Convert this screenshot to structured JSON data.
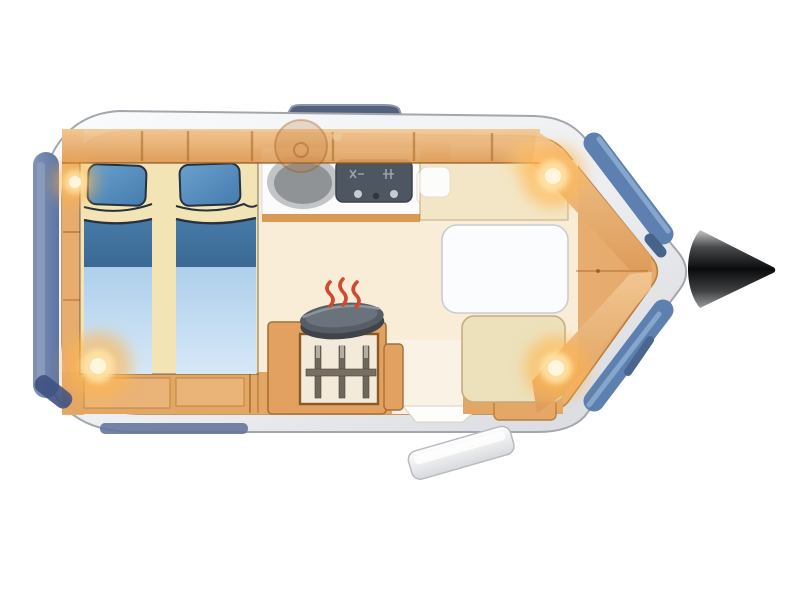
{
  "illustration": {
    "type": "caravan-floor-plan-top-view",
    "description_parts": [
      "body-shell",
      "tow-hitch-cone",
      "roof-hatch",
      "rear-window-left",
      "front-panorama-window-top",
      "front-panorama-window-bottom",
      "twin-bed-left",
      "twin-bed-right",
      "pillows",
      "overhead-cabinet-band",
      "kitchen-counter",
      "sink",
      "stove",
      "kitchen-island",
      "glass-front-cabinet",
      "cooking-pan",
      "heat-waves",
      "dinette-table",
      "dinette-bench-top",
      "dinette-bench-bottom",
      "corner-cabinet",
      "entry-step",
      "ceiling-lights"
    ],
    "ceiling_light_count": 4,
    "heat_wave_count": 3,
    "bottle_rod_count": 3
  },
  "colors": {
    "background": "#ffffff",
    "shell_outline": "#a3a7ad",
    "interior_orange": "#eab67f",
    "cabinet_orange": "#e3a765",
    "cabinet_line": "#b97f3f",
    "floor_cream": "#f9edd8",
    "walkway_cream": "#f9f2e5",
    "bed_base_cream": "#f3e4b6",
    "pillow_blue": "#4e87ba",
    "blanket_dark_blue": "#40719f",
    "blanket_light_blue": "#b7d3ee",
    "outline_navy": "#25313f",
    "counter_white": "#fbfbfb",
    "counter_edge_orange": "#d99a55",
    "sink_rim": "#c2c4c6",
    "sink_bowl": "#909396",
    "stove_slate": "#4d5661",
    "pan_gray": "#565d66",
    "pan_top": "#6a727c",
    "heat_red": "#cf4a2f",
    "table_white": "#fbfcfd",
    "bench_back_cream": "#f7edd6",
    "bench_cream": "#f3e6c6",
    "bench_tan": "#ece1bb",
    "bench_tan_line": "#c4ad7c",
    "seat_pad_white": "#fcfcfb",
    "window_blue": "#5d80b0",
    "window_blue_light": "#86a6cc",
    "window_blue_dark": "#46638c",
    "rear_window_blue": "#7087ae",
    "trim_navy": "#3e527f",
    "bottom_trim_blue": "#66759c",
    "roof_hatch_slate": "#55617c",
    "roof_hatch_edge": "#8b96ad",
    "step_gray_edge": "#b7bbbf",
    "door_threshold_white": "#fdfdfb",
    "rod_dark": "#6e675d",
    "rod_cap": "#b5ad9f",
    "rod_bar": "#786f63",
    "glass_panel": "#f4ead9",
    "hitch_gray": "#c6c7c9",
    "glow_warm": "#ffb54d",
    "glow_mid": "#ffe3a6",
    "glow_core": "#fff6dd"
  }
}
